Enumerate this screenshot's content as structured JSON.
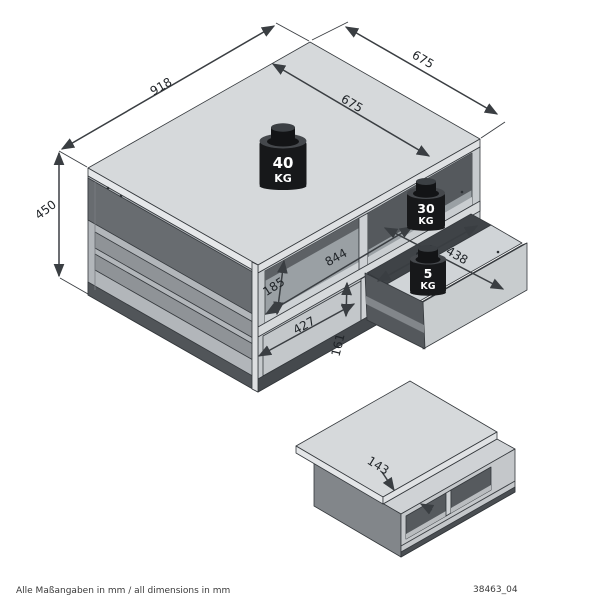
{
  "footer": {
    "note": "Alle Maßangaben in mm / all dimensions in mm",
    "code": "38463_04"
  },
  "main_view": {
    "weights": {
      "top": {
        "value": "40",
        "unit": "KG"
      },
      "shelf": {
        "value": "30",
        "unit": "KG"
      },
      "drawer": {
        "value": "5",
        "unit": "KG"
      }
    },
    "dimensions": {
      "width": "918",
      "depth": "675",
      "top_depth": "675",
      "height": "450",
      "niche_height": "185",
      "inner_width": "844",
      "drawer_front_width": "427",
      "drawer_front_height": "161",
      "drawer_inner_width": "400",
      "drawer_inner_depth": "438"
    }
  },
  "detail_view": {
    "dimensions": {
      "top_slide": "143"
    }
  },
  "colors": {
    "background": "#ffffff",
    "top_face": "#d6d9db",
    "side_face": "#b2b6ba",
    "front_face": "#c6cacd",
    "niche_interior": "#55595d",
    "plinth": "#45494d",
    "outline": "#34383c",
    "dimension_line": "#3a3e42",
    "weight_body": "#17181a",
    "label_text": "#1f2327"
  }
}
